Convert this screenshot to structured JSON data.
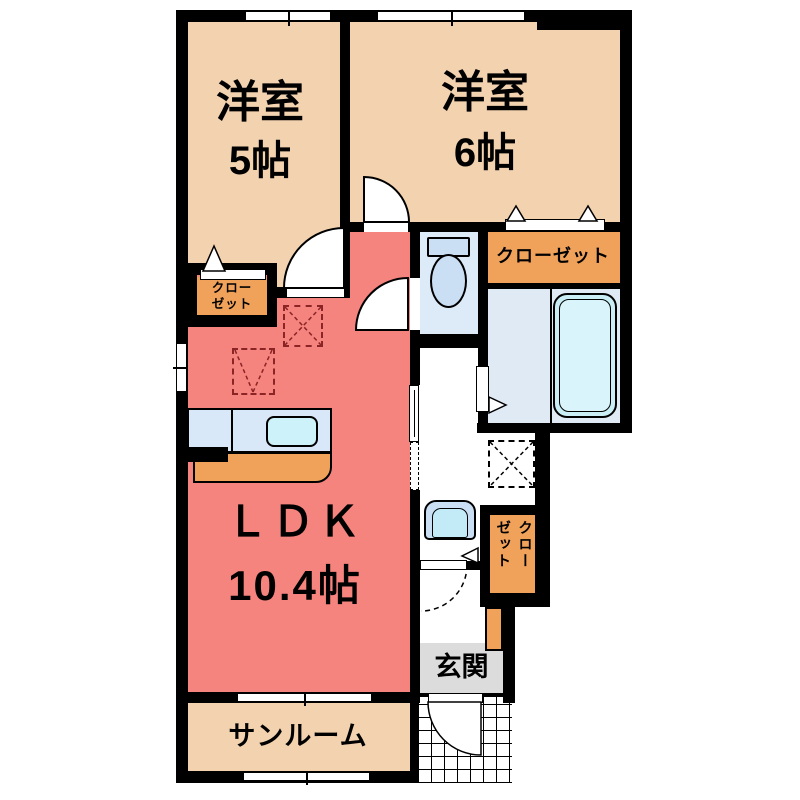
{
  "plan": {
    "rooms": {
      "bedroom5": {
        "name": "洋室",
        "size": "5帖"
      },
      "bedroom6": {
        "name": "洋室",
        "size": "6帖"
      },
      "ldk": {
        "name": "ＬＤＫ",
        "size": "10.4帖"
      },
      "sunroom": {
        "name": "サンルーム"
      },
      "entrance": {
        "name": "玄関"
      },
      "closet_top": {
        "label": "クローゼット"
      },
      "closet_small": {
        "line1": "クロー",
        "line2": "ゼット"
      },
      "closet_lower": {
        "label": "クローゼット"
      }
    }
  },
  "colors": {
    "wall": "#000000",
    "room": "#F2D2AF",
    "ldk": "#F5837E",
    "closet": "#F0A25B",
    "toiletfloor": "#DDEAF8",
    "bathfloor": "#DFEAF5",
    "tub": "#C9EEF6",
    "tubinner": "#D9F4FA",
    "blue": "#CBDFF4",
    "sink": "#CDF2FA",
    "basin": "#C2EBF7",
    "counter": "#D9E8F8",
    "gray": "#DCDCDC",
    "dashred": "#8B2424"
  }
}
